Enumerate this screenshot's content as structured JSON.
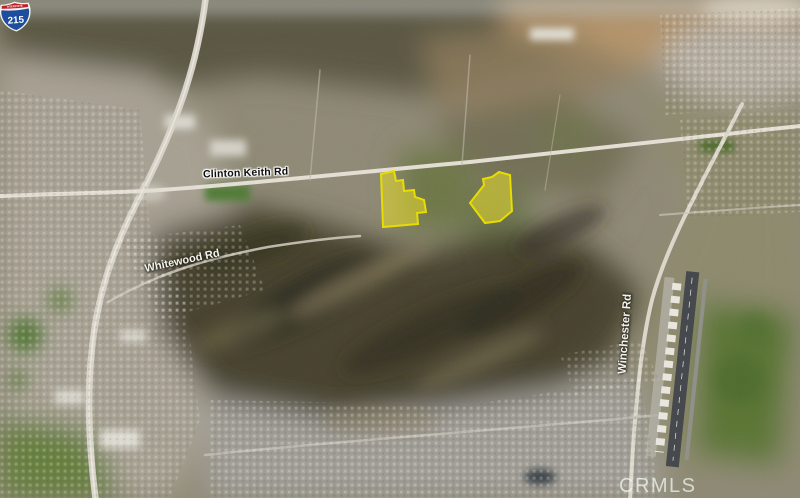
{
  "map": {
    "road_labels": {
      "clinton_keith": "Clinton Keith Rd",
      "whitewood": "Whitewood Rd",
      "winchester": "Winchester Rd"
    },
    "interstate_shield": {
      "banner": "INTERSTATE",
      "route": "215"
    },
    "watermark": "CRMLS",
    "highlight": {
      "fill": "#f0e32a",
      "stroke": "#e8dc00",
      "parcels": [
        {
          "name": "west-parcel",
          "points": "381,174 394,171 396,181 403,180 404,191 414,190 415,197 424,200 426,212 417,213 418,224 383,227"
        },
        {
          "name": "east-parcel",
          "points": "499,172 510,175 512,211 500,221 485,223 470,203 484,185 483,179 492,177"
        }
      ]
    }
  }
}
